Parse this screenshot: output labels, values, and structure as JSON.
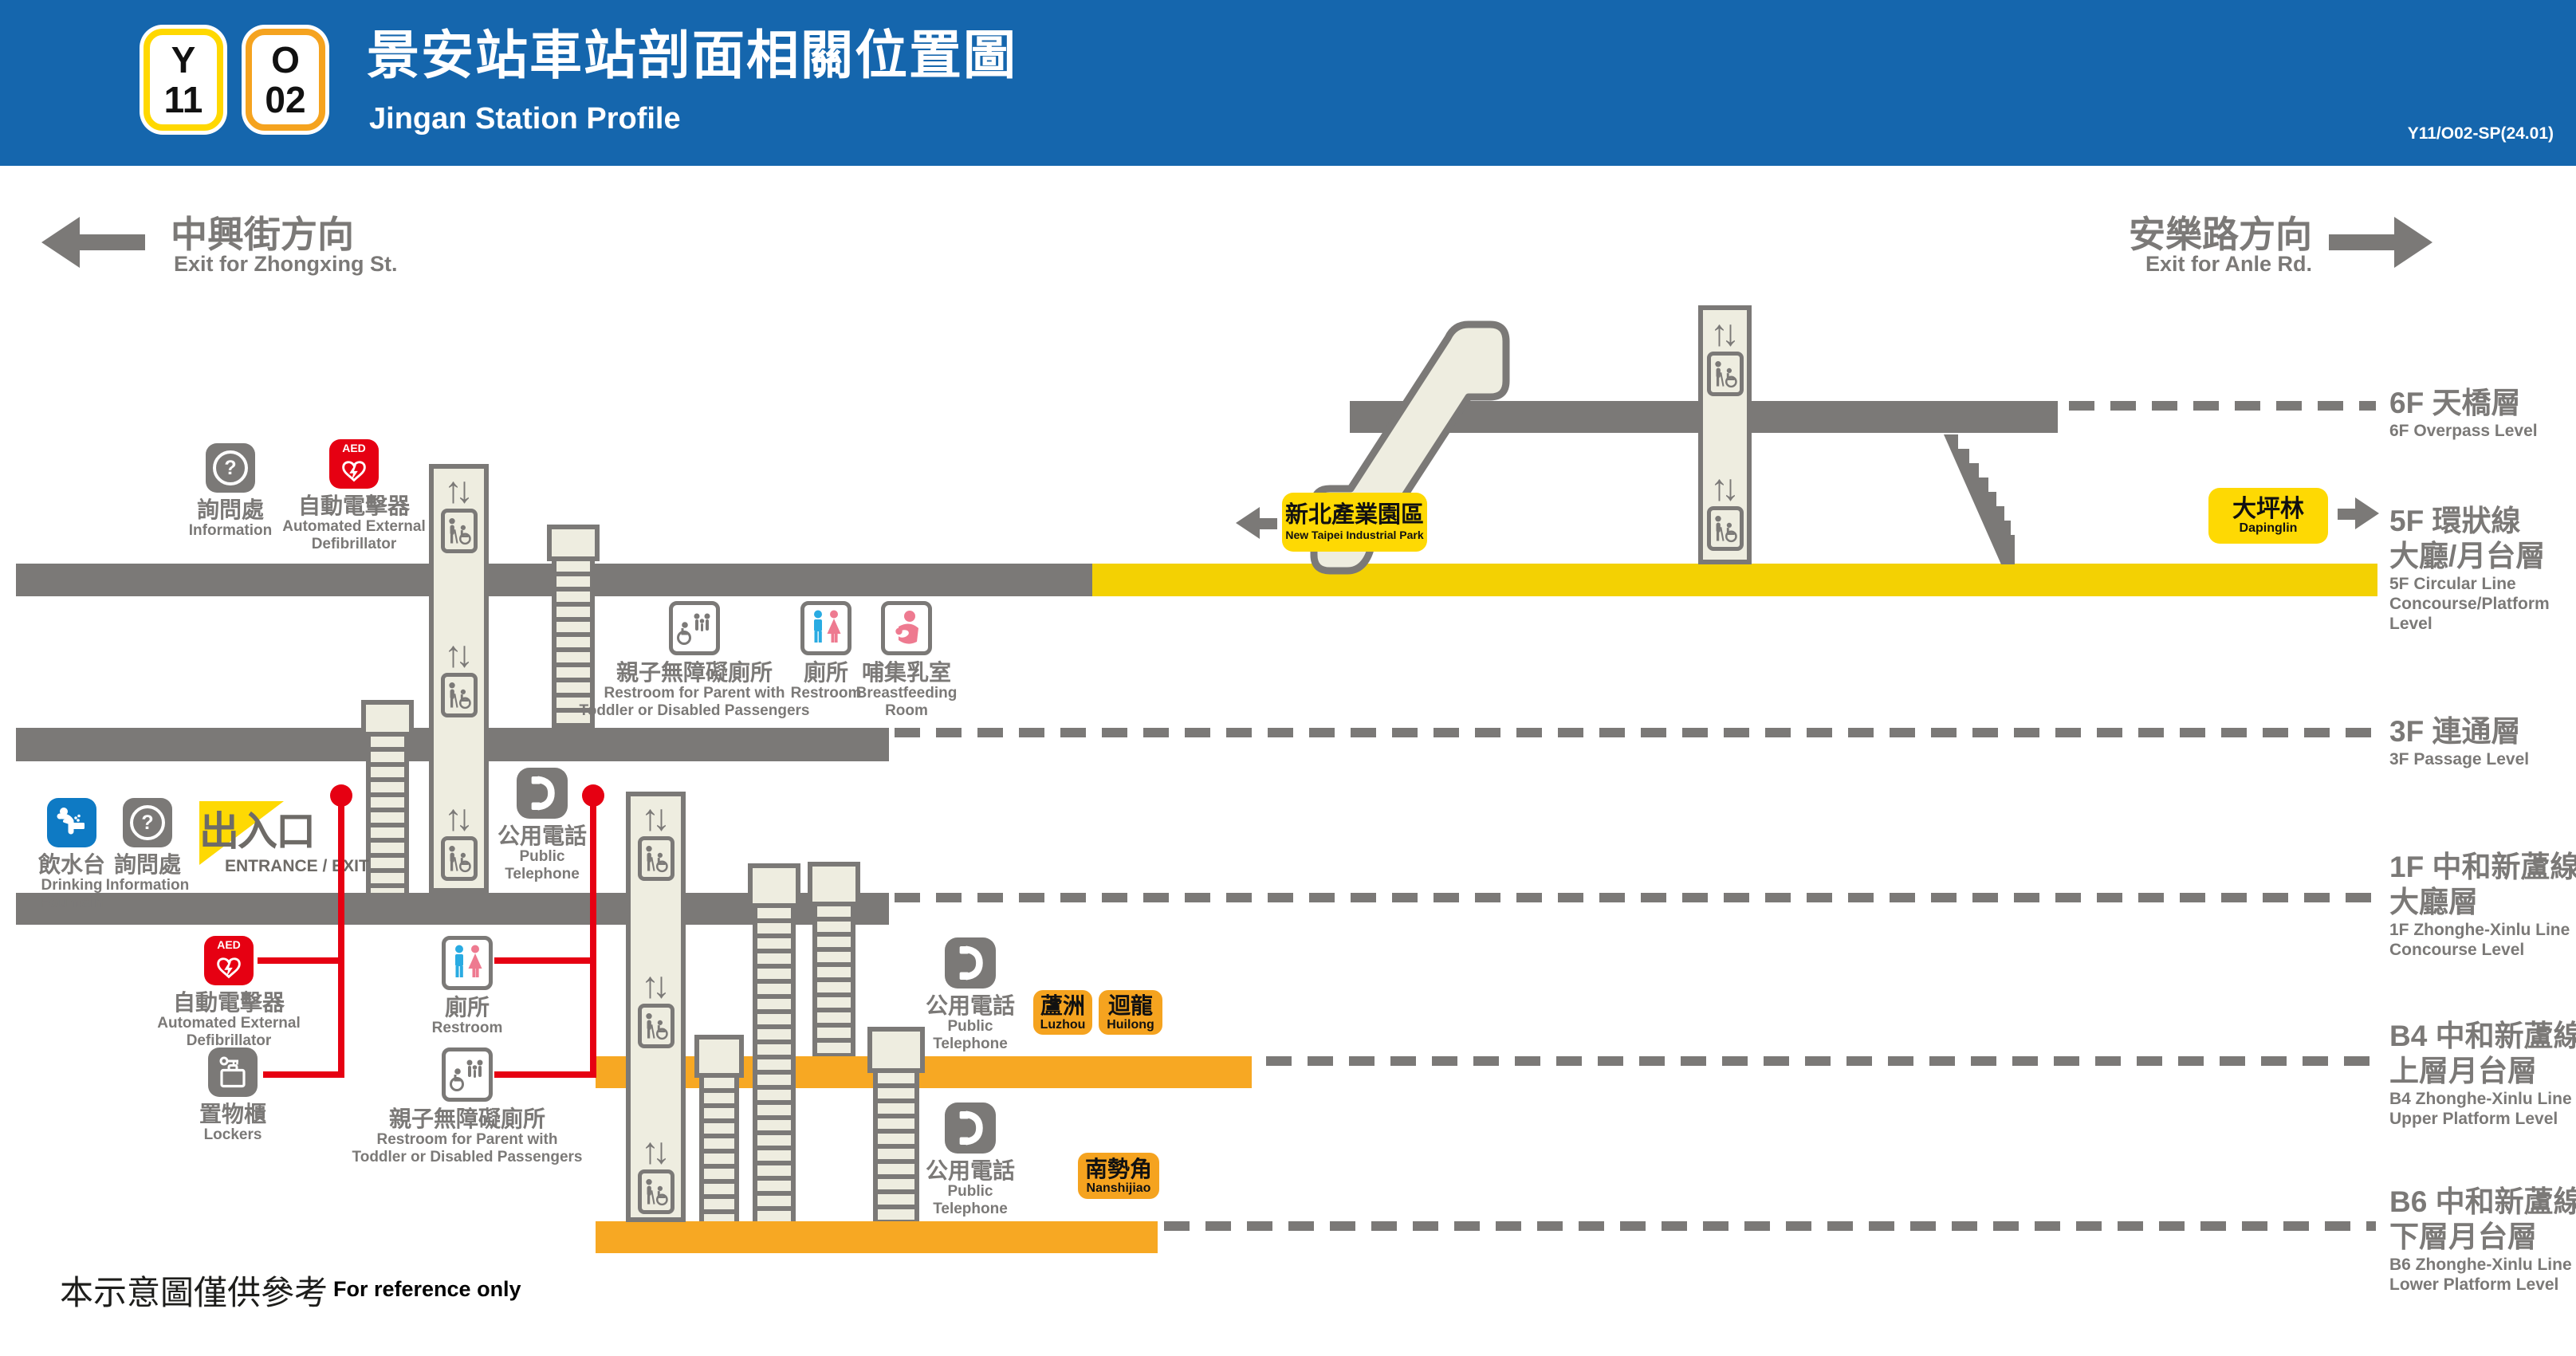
{
  "header": {
    "badges": [
      {
        "letter": "Y",
        "number": "11"
      },
      {
        "letter": "O",
        "number": "02"
      }
    ],
    "title_zh": "景安站車站剖面相關位置圖",
    "title_en": "Jingan Station Profile",
    "code": "Y11/O02-SP(24.01)"
  },
  "directions": {
    "left_zh": "中興街方向",
    "left_en": "Exit for Zhongxing St.",
    "right_zh": "安樂路方向",
    "right_en": "Exit for Anle Rd."
  },
  "levels": {
    "f6": {
      "zh": "6F 天橋層",
      "en": "6F Overpass Level"
    },
    "f5": {
      "zh1": "5F 環狀線",
      "zh2": "大廳/月台層",
      "en1": "5F Circular Line",
      "en2": "Concourse/Platform",
      "en3": "Level"
    },
    "f3": {
      "zh": "3F 連通層",
      "en": "3F Passage Level"
    },
    "f1": {
      "zh1": "1F 中和新蘆線",
      "zh2": "大廳層",
      "en1": "1F Zhonghe-Xinlu Line",
      "en2": "Concourse Level"
    },
    "b4": {
      "zh1": "B4 中和新蘆線",
      "zh2": "上層月台層",
      "en1": "B4 Zhonghe-Xinlu Line",
      "en2": "Upper Platform Level"
    },
    "b6": {
      "zh1": "B6 中和新蘆線",
      "zh2": "下層月台層",
      "en1": "B6 Zhonghe-Xinlu Line",
      "en2": "Lower Platform Level"
    }
  },
  "stations": {
    "industrial_park": {
      "zh": "新北產業園區",
      "en": "New Taipei Industrial Park"
    },
    "dapinglin": {
      "zh": "大坪林",
      "en": "Dapinglin"
    },
    "luzhou": {
      "zh": "蘆洲",
      "en": "Luzhou"
    },
    "huilong": {
      "zh": "迴龍",
      "en": "Huilong"
    },
    "nanshijiao": {
      "zh": "南勢角",
      "en": "Nanshijiao"
    }
  },
  "facilities": {
    "information": {
      "zh": "詢問處",
      "en": "Information"
    },
    "aed": {
      "zh": "自動電擊器",
      "en1": "Automated External",
      "en2": "Defibrillator"
    },
    "drinking_fountain": {
      "zh": "飲水台",
      "en1": "Drinking",
      "en2": "Fountain"
    },
    "entrance": {
      "zh": "出入口",
      "en": "ENTRANCE / EXIT"
    },
    "public_telephone": {
      "zh": "公用電話",
      "en1": "Public",
      "en2": "Telephone"
    },
    "restroom": {
      "zh": "廁所",
      "en": "Restroom"
    },
    "parent_restroom": {
      "zh": "親子無障礙廁所",
      "en1": "Restroom for Parent with",
      "en2": "Toddler or Disabled Passengers"
    },
    "breastfeeding": {
      "zh": "哺集乳室",
      "en1": "Breastfeeding",
      "en2": "Room"
    },
    "lockers": {
      "zh": "置物櫃",
      "en": "Lockers"
    }
  },
  "footer": {
    "zh": "本示意圖僅供參考",
    "en": "For reference only"
  },
  "icons": {
    "up_down": "↑↓",
    "question": "?",
    "aed": "AED"
  },
  "colors": {
    "header_blue": "#1566ad",
    "band_gray": "#7b7977",
    "circular_line_yellow": "#f3d103",
    "badge_yellow": "#fed903",
    "zhonghe_xinlu_orange": "#f7a823",
    "station_badge_orange": "#f5a31f",
    "alert_red": "#e60012",
    "fountain_blue": "#0e7ac4",
    "male_blue": "#29abe2",
    "female_pink": "#ee7a90",
    "structure_beige": "#eeede0"
  }
}
